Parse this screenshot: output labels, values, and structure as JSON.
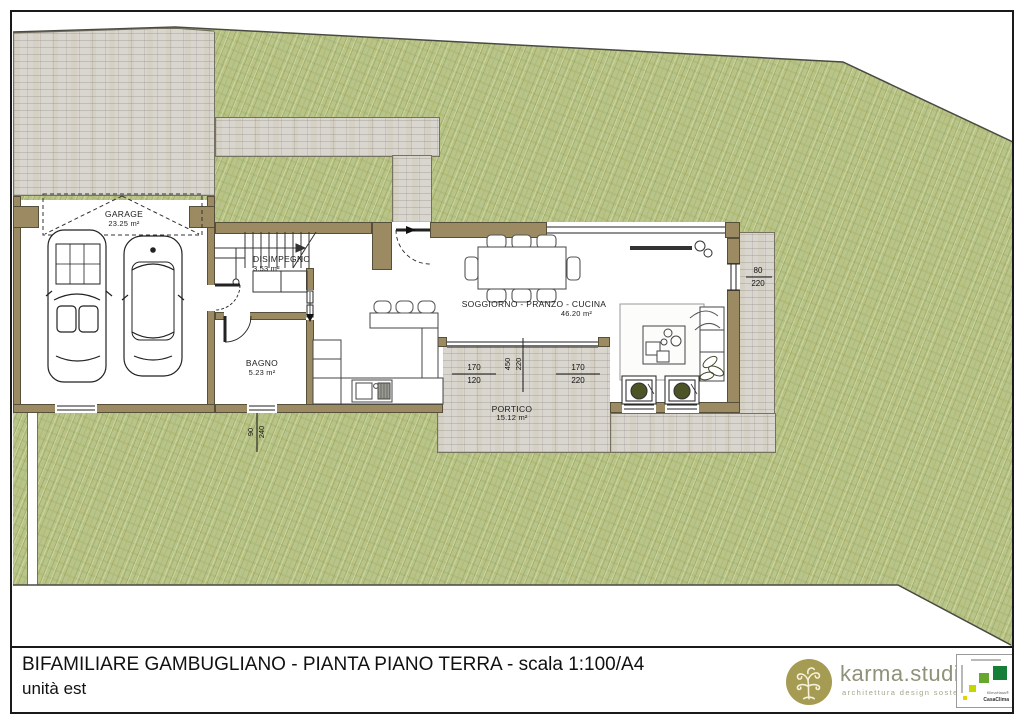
{
  "title_block": {
    "line1": "BIFAMILIARE GAMBUGLIANO - PIANTA PIANO TERRA - scala 1:100/A4",
    "line2": "unità est"
  },
  "branding": {
    "name": "karma.studio",
    "tagline": "architettura design sostenibilità",
    "badge_top": "KlimaHaus®",
    "badge_bottom": "CasaClima"
  },
  "rooms": [
    {
      "name": "GARAGE",
      "area": "23.25 m²"
    },
    {
      "name": "DISIMPEGNO",
      "area": "3.53 m²"
    },
    {
      "name": "BAGNO",
      "area": "5.23 m²"
    },
    {
      "name": "SOGGIORNO - PRANZO - CUCINA",
      "area": "46.20 m²"
    },
    {
      "name": "PORTICO",
      "area": "15.12 m²"
    }
  ],
  "dimensions": {
    "east_window": {
      "w": "80",
      "h": "220"
    },
    "portico_west_opening": {
      "w": "170",
      "h": "120"
    },
    "portico_east_opening": {
      "w": "170",
      "h": "220"
    },
    "portico_south_opening": {
      "w": "450",
      "h": "220"
    },
    "bath_window": {
      "w": "90",
      "h": "240"
    }
  },
  "colors": {
    "wall": "#9c8a63",
    "grass": "#b9c48b",
    "paving": "#d9d6cf",
    "logo_gold": "#a59b52",
    "cert_green": "#157f38",
    "title_text": "#111111"
  }
}
